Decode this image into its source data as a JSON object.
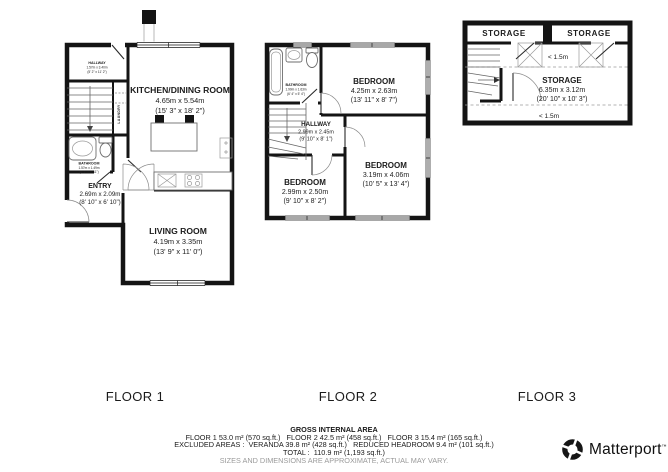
{
  "floors": [
    {
      "label": "FLOOR 1",
      "rooms": {
        "hallway": {
          "name": "HALLWAY",
          "metric": "1.57m x 3.40m",
          "imperial": "(5' 2\" x 11' 2\")"
        },
        "laundry": {
          "name": "LAUNDRY"
        },
        "bathroom": {
          "name": "BATHROOM",
          "metric": "1.57m x 1.49m",
          "imperial": "(5' 2\" x 4' 11\")"
        },
        "entry": {
          "name": "ENTRY",
          "metric": "2.69m x 2.09m",
          "imperial": "(8' 10\" x 6' 10\")"
        },
        "kitchen": {
          "name": "KITCHEN/DINING ROOM",
          "metric": "4.65m x 5.54m",
          "imperial": "(15' 3\" x 18' 2\")"
        },
        "living": {
          "name": "LIVING ROOM",
          "metric": "4.19m x 3.35m",
          "imperial": "(13' 9\" x 11' 0\")"
        }
      }
    },
    {
      "label": "FLOOR 2",
      "rooms": {
        "bathroom": {
          "name": "BATHROOM",
          "metric": "1.90m x 1.63m",
          "imperial": "(6' 4\" x 5' 4\")"
        },
        "hallway": {
          "name": "HALLWAY",
          "metric": "2.99m x 2.45m",
          "imperial": "(9' 10\" x 8' 1\")"
        },
        "bedroom_top": {
          "name": "BEDROOM",
          "metric": "4.25m x 2.63m",
          "imperial": "(13' 11\" x 8' 7\")"
        },
        "bedroom_right": {
          "name": "BEDROOM",
          "metric": "3.19m x 4.06m",
          "imperial": "(10' 5\" x 13' 4\")"
        },
        "bedroom_left": {
          "name": "BEDROOM",
          "metric": "2.99m x 2.50m",
          "imperial": "(9' 10\" x 8' 2\")"
        }
      }
    },
    {
      "label": "FLOOR 3",
      "rooms": {
        "storage_left": {
          "name": "STORAGE"
        },
        "storage_right": {
          "name": "STORAGE"
        },
        "storage_main": {
          "name": "STORAGE",
          "metric": "6.35m x 3.12m",
          "imperial": "(20' 10\" x 10' 3\")"
        }
      },
      "notes": {
        "headroom_top": "< 1.5m",
        "headroom_bottom": "< 1.5m"
      }
    }
  ],
  "footer": {
    "title": "GROSS INTERNAL AREA",
    "line1": "FLOOR 1 53.0 m² (570 sq.ft.)   FLOOR 2 42.5 m² (458 sq.ft.)   FLOOR 3 15.4 m² (165 sq.ft.)",
    "line2": "EXCLUDED AREAS :  VERANDA 39.8 m² (428 sq.ft.)   REDUCED HEADROOM 9.4 m² (101 sq.ft.)",
    "line3": "TOTAL :  110.9 m² (1,193 sq.ft.)",
    "disclaimer": "SIZES AND DIMENSIONS ARE APPROXIMATE, ACTUAL MAY VARY."
  },
  "brand": {
    "name": "Matterport",
    "tm": "™"
  },
  "colors": {
    "wall": "#141414",
    "text": "#1c1c1c",
    "muted": "#9a9a9a"
  }
}
